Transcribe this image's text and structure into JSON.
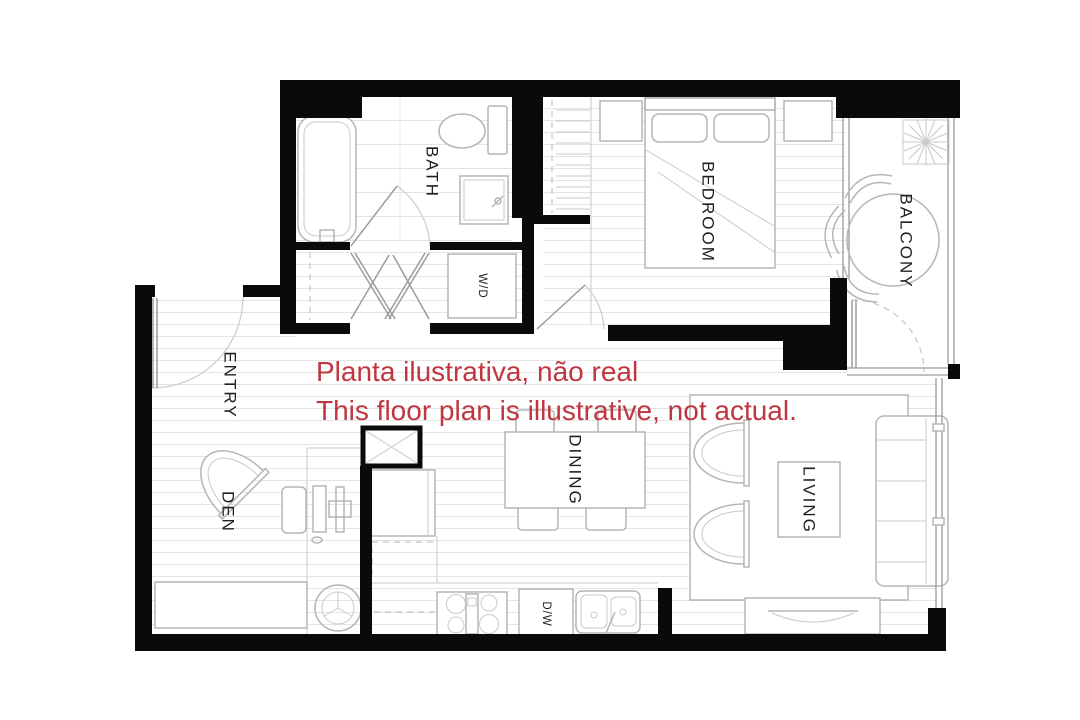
{
  "annotation": {
    "line1": "Planta ilustrativa, não real",
    "line2": "This floor plan is illustrative, not actual.",
    "color": "#bf3640"
  },
  "rooms": {
    "bath": {
      "label": "BATH"
    },
    "bedroom": {
      "label": "BEDROOM"
    },
    "balcony": {
      "label": "BALCONY"
    },
    "entry": {
      "label": "ENTRY"
    },
    "den": {
      "label": "DEN"
    },
    "dining": {
      "label": "DINING"
    },
    "living": {
      "label": "LIVING"
    },
    "laundry": {
      "label": "W/D"
    },
    "dishwasher": {
      "label": "D/W"
    }
  },
  "colors": {
    "background": "#ffffff",
    "walls": "#0a0a0a",
    "furniture_line": "#b5b5b5",
    "floor_line": "#e4e4e4",
    "annotation_red": "#bf3640"
  }
}
